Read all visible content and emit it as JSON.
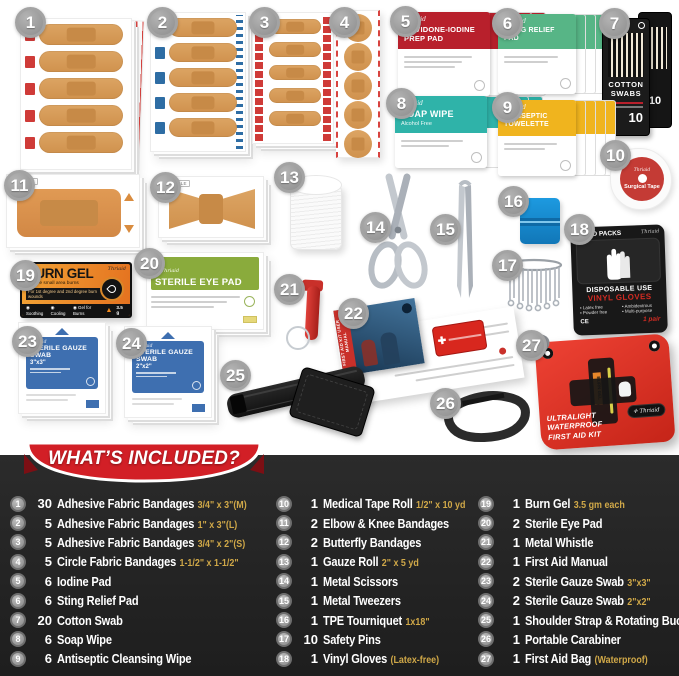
{
  "banner": {
    "title": "WHAT’S INCLUDED?"
  },
  "colors": {
    "panel_dark": "#232323",
    "ribbon_red": "#d21f26",
    "gold": "#d0a848",
    "badge_gray": "#9a9a9a",
    "bandage_tan": "#d69a58",
    "accent_red": "#c0392b",
    "accent_blue": "#2e6da4",
    "teal": "#2fb3a9",
    "green": "#57b586",
    "yellow": "#f0b41e",
    "eyepad_green": "#8aab3c",
    "gauze_blue": "#3e6fb0",
    "tourniquet_blue": "#1d9ae0",
    "bag_red": "#e23128"
  },
  "badges": [
    "1",
    "2",
    "3",
    "4",
    "5",
    "6",
    "7",
    "8",
    "9",
    "10",
    "11",
    "12",
    "13",
    "14",
    "15",
    "16",
    "17",
    "18",
    "19",
    "20",
    "21",
    "22",
    "23",
    "24",
    "25",
    "26",
    "27"
  ],
  "labels": {
    "brand": "Thriaid",
    "iodine": "POVIDONE-IODINE PREP PAD",
    "sting": "STING RELIEF PAD",
    "soap": "SOAP WIPE",
    "antiseptic": "ANTISEPTIC TOWELETTE",
    "alcohol_free": "Alcohol Free",
    "cotton": "COTTON SWABS",
    "cotton_count": "10",
    "tape": "Surgical Tape",
    "sterile": "STERILE",
    "burn_title": "BURN GEL",
    "burn_sub": "Relieve small area burns",
    "burn_line": "For 1st degree and 2nd degree burn wounds",
    "burn_b1": "Soothing",
    "burn_b2": "Cooling",
    "burn_b3": "Gel for Burns",
    "burn_wt": "3.5 g",
    "eye": "STERILE EYE PAD",
    "gauze": "STERILE GAUZE SWAB",
    "g33": "3\"x3\"",
    "g22": "2\"x2\"",
    "med_packs": "MED PACKS",
    "gloves1": "DISPOSABLE USE",
    "gloves2": "VINYL GLOVES",
    "glb1": "Latex free",
    "glb2": "Powder free",
    "glb3": "Ambidextrous",
    "glb4": "Multi-purpose",
    "gloves_qty": "1 pair",
    "bag1": "ULTRALIGHT",
    "bag2": "WATERPROOF",
    "bag3": "FIRST AID KIT",
    "manual": "FIRST AID KIT USER MANUAL"
  },
  "included": {
    "columns": [
      [
        {
          "num": "1",
          "qty": "30",
          "name": "Adhesive Fabric Bandages",
          "spec": "3/4\" x 3\"(M)"
        },
        {
          "num": "2",
          "qty": "5",
          "name": "Adhesive Fabric Bandages",
          "spec": "1\" x 3\"(L)"
        },
        {
          "num": "3",
          "qty": "5",
          "name": "Adhesive Fabric Bandages",
          "spec": "3/4\" x 2\"(S)"
        },
        {
          "num": "4",
          "qty": "5",
          "name": "Circle Fabric Bandages",
          "spec": "1-1/2\" x 1-1/2\""
        },
        {
          "num": "5",
          "qty": "6",
          "name": "Iodine Pad",
          "spec": ""
        },
        {
          "num": "6",
          "qty": "6",
          "name": "Sting Relief Pad",
          "spec": ""
        },
        {
          "num": "7",
          "qty": "20",
          "name": "Cotton Swab",
          "spec": ""
        },
        {
          "num": "8",
          "qty": "6",
          "name": "Soap Wipe",
          "spec": ""
        },
        {
          "num": "9",
          "qty": "6",
          "name": "Antiseptic Cleansing Wipe",
          "spec": ""
        }
      ],
      [
        {
          "num": "10",
          "qty": "1",
          "name": "Medical Tape Roll",
          "spec": "1/2\" x 10 yd"
        },
        {
          "num": "11",
          "qty": "2",
          "name": "Elbow & Knee Bandages",
          "spec": ""
        },
        {
          "num": "12",
          "qty": "2",
          "name": "Butterfly Bandages",
          "spec": ""
        },
        {
          "num": "13",
          "qty": "1",
          "name": "Gauze Roll",
          "spec": "2\" x 5 yd"
        },
        {
          "num": "14",
          "qty": "1",
          "name": "Metal Scissors",
          "spec": ""
        },
        {
          "num": "15",
          "qty": "1",
          "name": "Metal Tweezers",
          "spec": ""
        },
        {
          "num": "16",
          "qty": "1",
          "name": "TPE Tourniquet",
          "spec": "1x18\""
        },
        {
          "num": "17",
          "qty": "10",
          "name": "Safety Pins",
          "spec": ""
        },
        {
          "num": "18",
          "qty": "1",
          "name": "Vinyl Gloves",
          "spec": "(Latex-free)"
        }
      ],
      [
        {
          "num": "19",
          "qty": "1",
          "name": "Burn Gel",
          "spec": "3.5 gm each"
        },
        {
          "num": "20",
          "qty": "2",
          "name": "Sterile Eye Pad",
          "spec": ""
        },
        {
          "num": "21",
          "qty": "1",
          "name": "Metal Whistle",
          "spec": ""
        },
        {
          "num": "22",
          "qty": "1",
          "name": "First Aid Manual",
          "spec": ""
        },
        {
          "num": "23",
          "qty": "2",
          "name": "Sterile Gauze Swab",
          "spec": "3\"x3\""
        },
        {
          "num": "24",
          "qty": "2",
          "name": "Sterile Gauze Swab",
          "spec": "2\"x2\""
        },
        {
          "num": "25",
          "qty": "1",
          "name": "Shoulder Strap & Rotating Buckle",
          "spec": ""
        },
        {
          "num": "26",
          "qty": "1",
          "name": "Portable Carabiner",
          "spec": ""
        },
        {
          "num": "27",
          "qty": "1",
          "name": "First Aid Bag",
          "spec": "(Waterproof)"
        }
      ]
    ]
  }
}
